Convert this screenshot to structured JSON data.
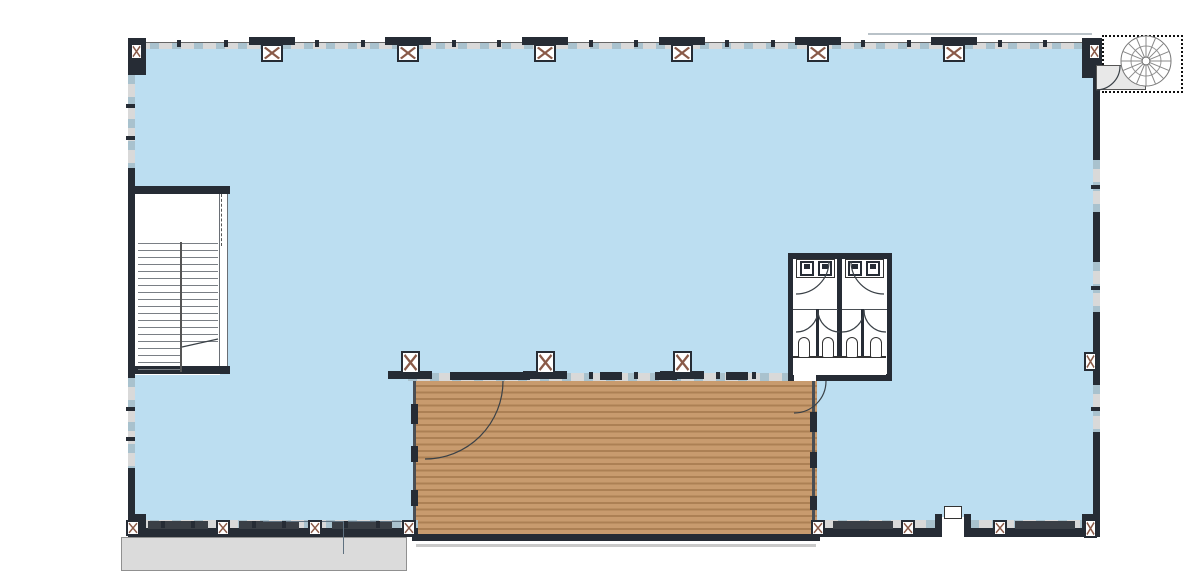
{
  "drawing": {
    "type": "architectural-floor-plan",
    "description": "upper floor plan with open area, wood deck, switchback stair, spiral stair and restrooms",
    "visible_text_labels": []
  },
  "colors": {
    "interior_fill": "#BCDEF1",
    "wall_dark": "#262C35",
    "window_band": "#D9D9D9",
    "window_dash": "#A9C2CE",
    "deck_plank_light": "#C89B6E",
    "deck_plank_dark": "#AC8054",
    "canopy_gray": "#DBDBDB",
    "tread_line": "#7A7F85",
    "column_x_mark": "#8A5A48",
    "linework": "#3A4147",
    "ref_line": "#5F7180"
  },
  "features": {
    "columns": {
      "top_x": [
        272,
        408,
        545,
        682,
        818,
        954
      ],
      "top_corners_x": [
        133,
        1091
      ],
      "bottom_left_x": [
        133,
        223,
        315,
        409
      ],
      "bottom_right_x": [
        818,
        908,
        1000,
        1091
      ],
      "deck_x": [
        410,
        545,
        682
      ],
      "right_wall_y": [
        352,
        519
      ]
    },
    "restrooms": {
      "rooms": 2,
      "toilets_x": [
        804,
        828,
        852,
        876
      ],
      "sinks_x": [
        800,
        818,
        848,
        866
      ]
    },
    "stair": {
      "left_treads": 19,
      "right_treads": 15
    },
    "spiral_stair": {
      "spokes": 16
    },
    "door_swings": 8,
    "exterior_door_bottom_right": true,
    "entrance_canopy_bottom_left": true
  }
}
